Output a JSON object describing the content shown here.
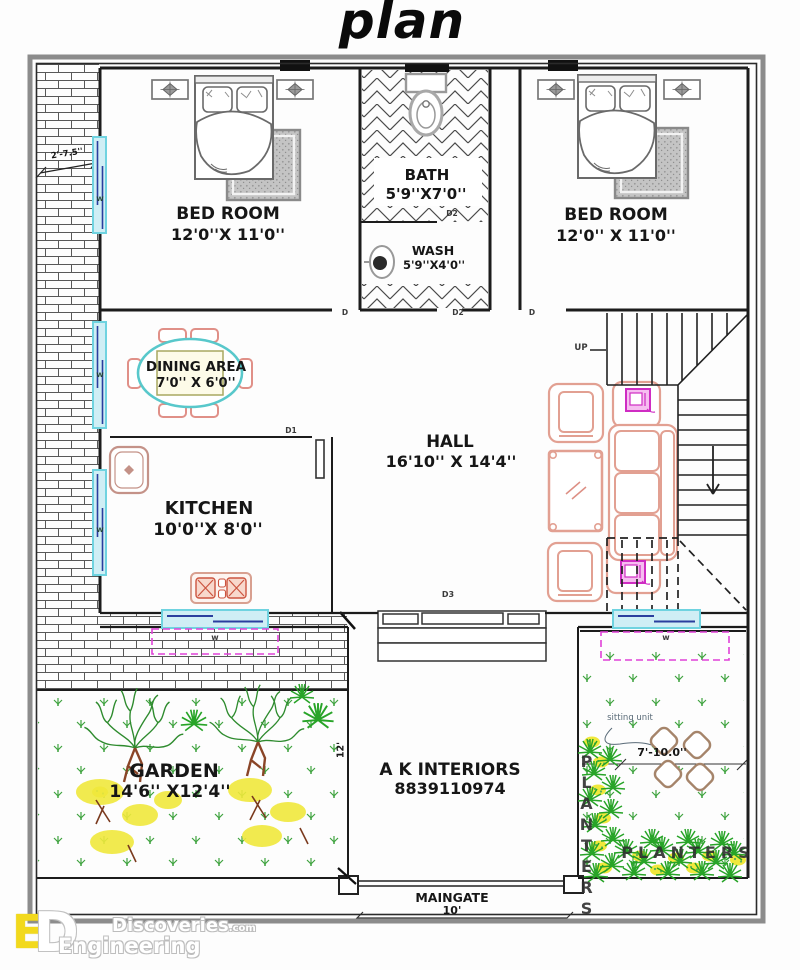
{
  "title": "plan",
  "rooms": {
    "bedroom_left": {
      "name": "BED ROOM",
      "dims": "12'0''X 11'0''"
    },
    "bath": {
      "name": "BATH",
      "dims": "5'9''X7'0''"
    },
    "wash": {
      "name": "WASH",
      "dims": "5'9''X4'0''"
    },
    "bedroom_right": {
      "name": "BED ROOM",
      "dims": "12'0'' X 11'0''"
    },
    "dining": {
      "name": "DINING AREA",
      "dims": "7'0'' X 6'0''"
    },
    "kitchen": {
      "name": "KITCHEN",
      "dims": "10'0''X 8'0''"
    },
    "hall": {
      "name": "HALL",
      "dims": "16'10'' X 14'4''"
    },
    "garden": {
      "name": "GARDEN",
      "dims": "14'6'' X12'4''"
    },
    "maingate": {
      "name": "MAINGATE",
      "dims": "10'"
    }
  },
  "porch": {
    "brand": "A K INTERIORS",
    "phone": "8839110974",
    "depth_dim": "12'"
  },
  "stairs": {
    "up": "UP"
  },
  "side_passage": {
    "width_dim": "2'-7.5''"
  },
  "garden_right": {
    "sitting_label": "sitting unit",
    "sitting_dim": "7'-10.0''",
    "planters_vertical": "PLANTERS",
    "planters_horizontal": "PLANTERS"
  },
  "doors": {
    "bedroom_left": "D",
    "bedroom_right": "D",
    "bath": "D2",
    "wash": "D2",
    "kitchen": "D1",
    "main": "D3"
  },
  "windows": {
    "bedroom_left_w": "W",
    "dining_w": "W",
    "kitchen_w": "W",
    "garden_left_w": "w",
    "garden_right_w": "w"
  },
  "watermark": {
    "mono_e": "E",
    "mono_d": "D",
    "brand": "Discoveries",
    "brand_suffix": ".com",
    "line2": "Engineering"
  },
  "colors": {
    "wall": "#1c1c1c",
    "furniture_pink": "#e2a092",
    "dining_teal": "#58c8cb",
    "window_cyan": "#cfeef5",
    "window_frame": "#6fd3e0",
    "glass_navy": "#2a3e9e",
    "magenta": "#e042d8",
    "appliance_magenta": "#cf2cc3",
    "grass_green": "#3fa33f",
    "tree_green": "#2e8b2e",
    "flower_yellow": "#f0e83c",
    "trunk_brown": "#8a4527",
    "bush_green": "#28a428",
    "rug_gray": "#c4c4c4",
    "logo_yellow": "#f2d91c"
  }
}
